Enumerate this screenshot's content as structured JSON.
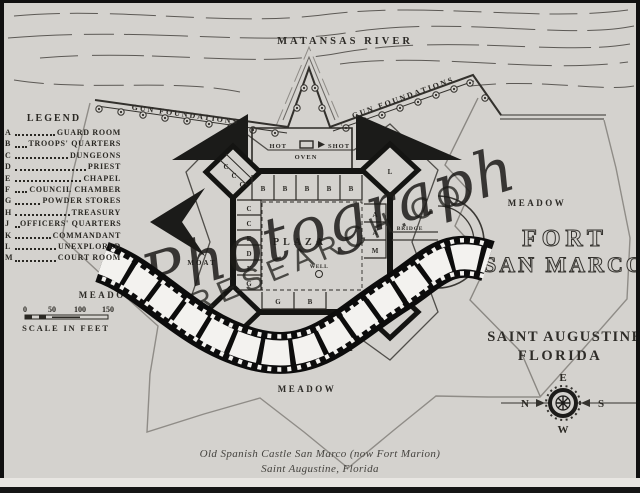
{
  "labels": {
    "river": "MATANSAS RIVER",
    "gun_foundations_left": "GUN FOUNDATIONS",
    "gun_foundations_right": "GUN FOUNDATIONS",
    "hot": "HOT",
    "shot": "SHOT",
    "oven": "OVEN",
    "plaza": "PLAZA",
    "well": "WELL",
    "bridge": "BRIDGE",
    "moat_west": "MOAT",
    "moat_south": "MOAT",
    "salt_marsh": "SALT MARSH",
    "meadow_west": "MEADOW",
    "meadow_east": "MEADOW",
    "meadow_south": "MEADOW",
    "fort_title_line1": "FORT",
    "fort_title_line2": "SAN MARCO",
    "city_line1": "SAINT AUGUSTINE",
    "city_line2": "FLORIDA"
  },
  "legend": {
    "title": "LEGEND",
    "items": [
      {
        "key": "A",
        "label": "GUARD ROOM"
      },
      {
        "key": "B",
        "label": "TROOPS' QUARTERS"
      },
      {
        "key": "C",
        "label": "DUNGEONS"
      },
      {
        "key": "D",
        "label": "PRIEST"
      },
      {
        "key": "E",
        "label": "CHAPEL"
      },
      {
        "key": "F",
        "label": "COUNCIL CHAMBER"
      },
      {
        "key": "G",
        "label": "POWDER STORES"
      },
      {
        "key": "H",
        "label": "TREASURY"
      },
      {
        "key": "J",
        "label": "OFFICERS' QUARTERS"
      },
      {
        "key": "K",
        "label": "COMMANDANT"
      },
      {
        "key": "L",
        "label": "UNEXPLORED"
      },
      {
        "key": "M",
        "label": "COURT ROOM"
      }
    ]
  },
  "scale": {
    "ticks": [
      "0",
      "50",
      "100",
      "150"
    ],
    "label": "SCALE IN FEET"
  },
  "compass": {
    "top": "E",
    "left": "N",
    "right": "S",
    "bottom": "W"
  },
  "rooms": {
    "nw": [
      "C",
      "C",
      "C"
    ],
    "top": [
      "B",
      "B",
      "B",
      "B",
      "B"
    ],
    "left": [
      "C",
      "C",
      "E",
      "D",
      "F",
      "G"
    ],
    "right": [
      "A",
      "A",
      "M"
    ],
    "bottom": [
      "G",
      "B"
    ],
    "bastions": [
      "L",
      "L"
    ]
  },
  "watermark": {
    "script_text": "Photograph",
    "arc_text": "RESEARCH.COM"
  },
  "caption": {
    "line1": "Old Spanish Castle San Marco (now Fort Marion)",
    "line2": "Saint Augustine, Florida"
  }
}
